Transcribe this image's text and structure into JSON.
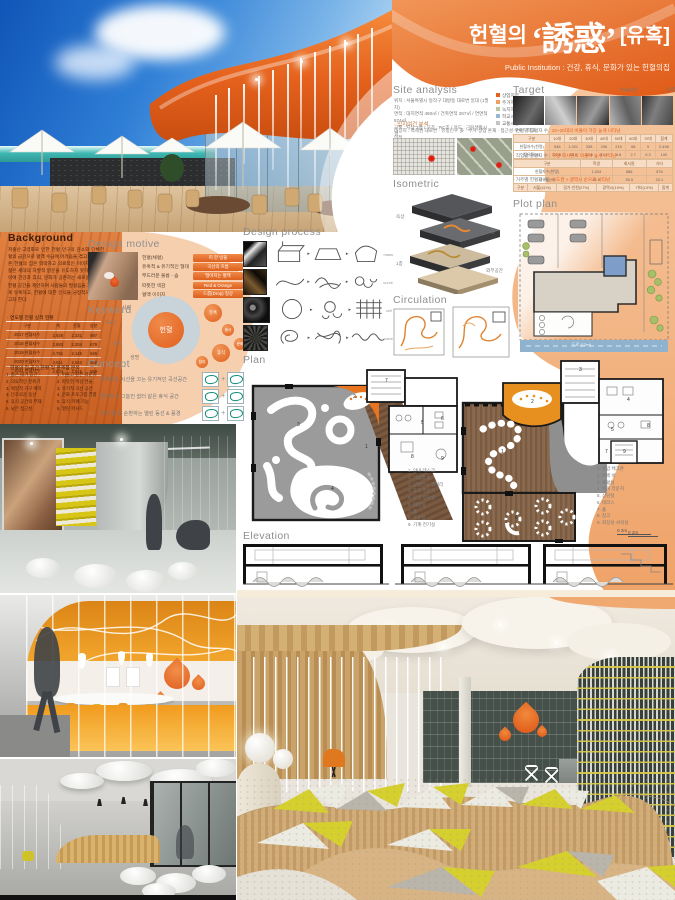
{
  "title": {
    "prefix": "헌혈의",
    "main": "‘誘惑’",
    "suffix": "[유혹]",
    "subtitle": "Public Institution : 건강, 휴식, 문화가 있는 헌혈의집"
  },
  "colors": {
    "accent": "#e4601f",
    "peach": "#f3b98d",
    "peach_light": "#f6cfae",
    "header_gray": "#8f8f8f"
  },
  "background": {
    "header": "Background",
    "paragraph": "저출산·고령화로 인한 헌혈 인구의 감소와 단체헌혈의 급감으로 혈액 수급에 어려움을 겪고 있다. 기존 헌혈의 집은 딱딱하고 의료적인 이미지로 인해 젊은 세대의 자발적 방문을 유도하지 못하고 있다. 이에 건강과 휴식, 문화가 공존하는 새로운 개념의 헌혈 공간을 제안하여 사람들의 발걸음을 자연스럽게 유혹하고, 헌혈에 대한 인식을 긍정적으로 바꾸고자 한다.",
    "table_title": "· 연도별 헌혈 실적 현황",
    "table": {
      "headers": [
        "구분",
        "계",
        "전혈",
        "성분"
      ],
      "rows": [
        [
          "2017 헌혈자수",
          "2,928",
          "2,231",
          "697"
        ],
        [
          "2018 헌혈자수",
          "2,883",
          "2,204",
          "679"
        ],
        [
          "2019 헌혈자수",
          "2,791",
          "2,145",
          "646"
        ],
        [
          "2020 헌혈자수",
          "2,611",
          "2,043",
          "568"
        ],
        [
          "2021 헌혈자수",
          "2,604",
          "2,015",
          "589"
        ]
      ]
    },
    "list_title": "· 헌혈의 집 공간 현황 및 문제점 분석",
    "list_left": [
      "1. 좁은 대기 공간",
      "2. 의료적인 분위기",
      "3. 획일적 가구 배치",
      "4. 단조로운 동선",
      "5. 휴식 공간의 부재",
      "6. 낮은 접근성"
    ],
    "list_right": [
      "1. 머물고 싶은 라운지",
      "2. 따뜻한 색감 연출",
      "3. 유기적 곡선 공간",
      "4. 문화 프로그램 결합",
      "5. 휴식·카페 기능",
      "6. 열린 파사드"
    ]
  },
  "design_motive": {
    "header": "Design motive",
    "items": [
      {
        "label": "헌혈(채혈)",
        "tag": "피 한 방울"
      },
      {
        "label": "유혹적 & 유기적인 형태",
        "tag": "곡선의 흐름"
      },
      {
        "label": "부드러운 볼륨 - 솜",
        "tag": "떨어지는 혈액"
      },
      {
        "label": "따뜻한 색감",
        "tag": "Red & Orange"
      },
      {
        "label": "혈액 이미지",
        "tag": "드롭(Drop) 형상"
      }
    ]
  },
  "keyword": {
    "header": "Keyword",
    "center": "헌혈",
    "words": [
      "Red",
      "사랑",
      "나눔",
      "생명",
      "유혹",
      "봉사",
      "휴식",
      "문화",
      "참여"
    ]
  },
  "concept": {
    "header": "Concept",
    "items": [
      {
        "num": "01 ·",
        "text": "유혹하듯 시선을 끄는 유기적인 곡선공간"
      },
      {
        "num": "02 ·",
        "text": "편안하고 그늘진 쉼터 같은 휴식 공간"
      },
      {
        "num": "03 ·",
        "text": "피가 돌 듯 순환하는 열린 동선 & 풍경"
      }
    ]
  },
  "design_process": {
    "header": "Design process",
    "rows": [
      {
        "caption": "mass"
      },
      {
        "caption": "curve"
      },
      {
        "caption": "cell"
      },
      {
        "caption": "wave"
      }
    ]
  },
  "site_analysis": {
    "header": "Site analysis",
    "lines": [
      "위치 : 서울특별시 동작구 대방동 대로변 일대 (1필지)",
      "면적 : 대지면적 460㎡ / 건축면적 287㎡ / 연면적 574㎡",
      "규모 : 지상 2층 / 구조 : RC조 / 용도 : 근린생활시설"
    ],
    "legend": [
      {
        "c": "#e4601f",
        "t": "상업지역"
      },
      {
        "c": "#f0a060",
        "t": "주거지역"
      },
      {
        "c": "#b7c8a0",
        "t": "녹지지역"
      },
      {
        "c": "#9ab7d8",
        "t": "학교시설"
      },
      {
        "c": "#c4c4c4",
        "t": "교통시설"
      }
    ],
    "bullet": "· 입지여건 분석",
    "note": "대상지 : 역세권 대로변 · 유동인구 多 · 주거·상업 혼재 · 접근성 우수 · 학교 인접"
  },
  "target": {
    "header": "Target",
    "note_gray": "Target은 ",
    "note_accent": "2030 MZ세대",
    "note_tail": " 중심",
    "b1g": "· 연령별 헌혈자 수 : ",
    "b1o": "10~20대의 비율이 가장 높게 나타남",
    "t1": {
      "headers": [
        "구분",
        "10대",
        "20대",
        "30대",
        "40대",
        "50대",
        "60대",
        "70대",
        "합계"
      ],
      "rows": [
        [
          "헌혈자수(천명)",
          "545",
          "1,021",
          "338",
          "296",
          "219",
          "68",
          "9",
          "2,496"
        ],
        [
          "점유율(%)",
          "21.8",
          "40.9",
          "13.6",
          "11.9",
          "8.8",
          "2.7",
          "0.3",
          "100"
        ]
      ]
    },
    "b2g": "· 직업별 헌혈자 수 : ",
    "b2o": "학생·회사원의 비율이 높게 나타남",
    "t2": {
      "headers": [
        "구분",
        "학생",
        "회사원",
        "기타"
      ],
      "rows": [
        [
          "헌혈자수(천명)",
          "1,034",
          "886",
          "576"
        ],
        [
          "점유율(%)",
          "41.4",
          "35.5",
          "23.1"
        ]
      ]
    },
    "b3g": "· 거주별 헌혈자 수 : ",
    "b3o": "수도권 > 광역시 순으로 나타남",
    "t3": {
      "headers": [
        "구분",
        "서울(41%)",
        "경기·인천(27%)",
        "광역시(19%)",
        "기타(13%)",
        "합계"
      ],
      "rows": []
    }
  },
  "isometric": {
    "header": "Isometric",
    "labels": [
      "옥상",
      "2층",
      "1층",
      "외부공간"
    ]
  },
  "plot_plan": {
    "header": "Plot plan",
    "road": "도로 (12m)"
  },
  "circulation": {
    "header": "Circulation"
  },
  "plan": {
    "header": "Plan",
    "legend1": [
      "1. 안내 데스크",
      "2. 기념품 숍",
      "3. 상설전시 갤러리",
      "4. 휴게 라운지",
      "5. 문진·상담실",
      "6. 화장실",
      "7. 홀",
      "8. 수유실",
      "9. 기계·전기실"
    ],
    "legend2": [
      "1. 혈압 체크존",
      "2. 카페 바",
      "3. 채혈실",
      "4. 회복 라운지",
      "5. 상담실",
      "6. 테라스",
      "7. 홀",
      "8. 창고",
      "9. 화장실·샤워실"
    ],
    "scale": "0    2m"
  },
  "elevation": {
    "header": "Elevation",
    "scale": "0    2m"
  }
}
